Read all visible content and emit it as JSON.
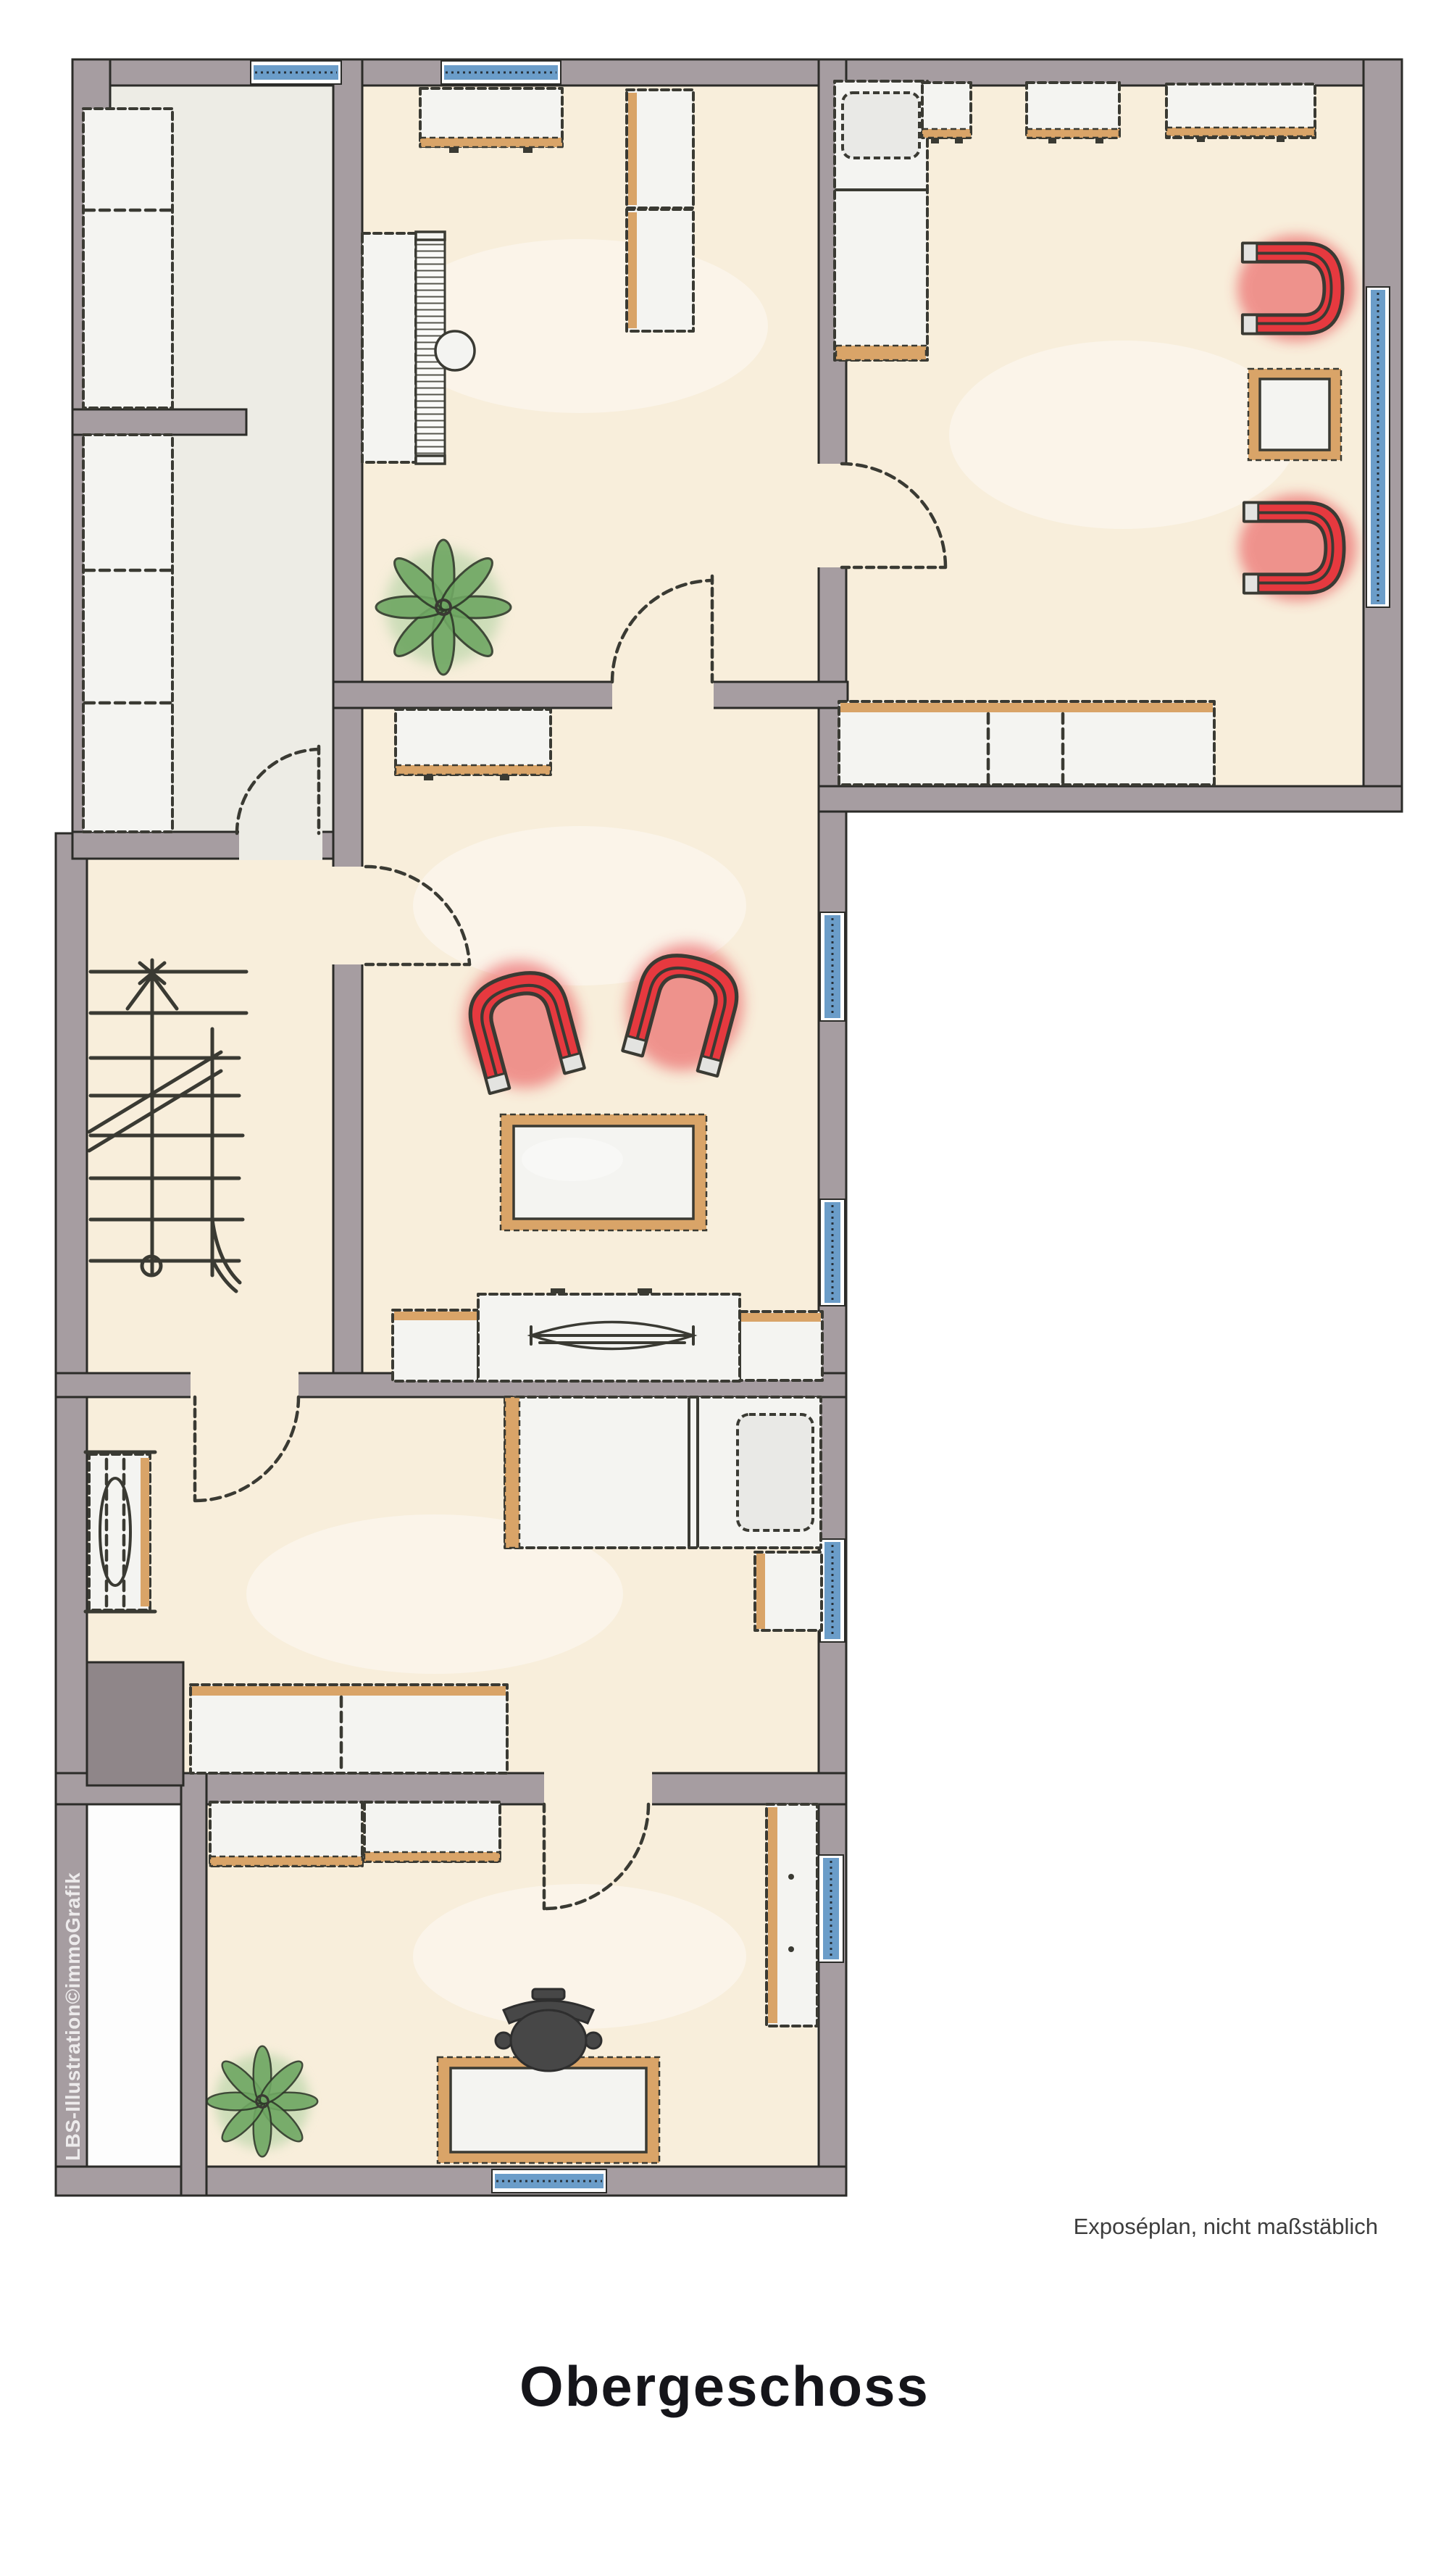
{
  "texts": {
    "title": "Obergeschoss",
    "caption": "Exposéplan, nicht maßstäblich",
    "watermark": "LBS-Illustration©immoGrafik"
  },
  "colors": {
    "background": "#ffffff",
    "wall_fill": "#a69da1",
    "wall_edge": "#2b2b28",
    "floor_cream": "#f8eedb",
    "floor_gray": "#edece5",
    "floor_white": "#fdfdfd",
    "furniture_fill": "#f4f4f1",
    "furniture_outline": "#3a3a33",
    "wood_accent": "#d9a468",
    "window_blue": "#6b9dc9",
    "armchair_red": "#e6393f",
    "plant_green": "#6fa763",
    "office_chair_gray": "#474747",
    "built_in_gray": "#8f8689",
    "text_color": "#3d3d3d",
    "title_color": "#15151a"
  }
}
